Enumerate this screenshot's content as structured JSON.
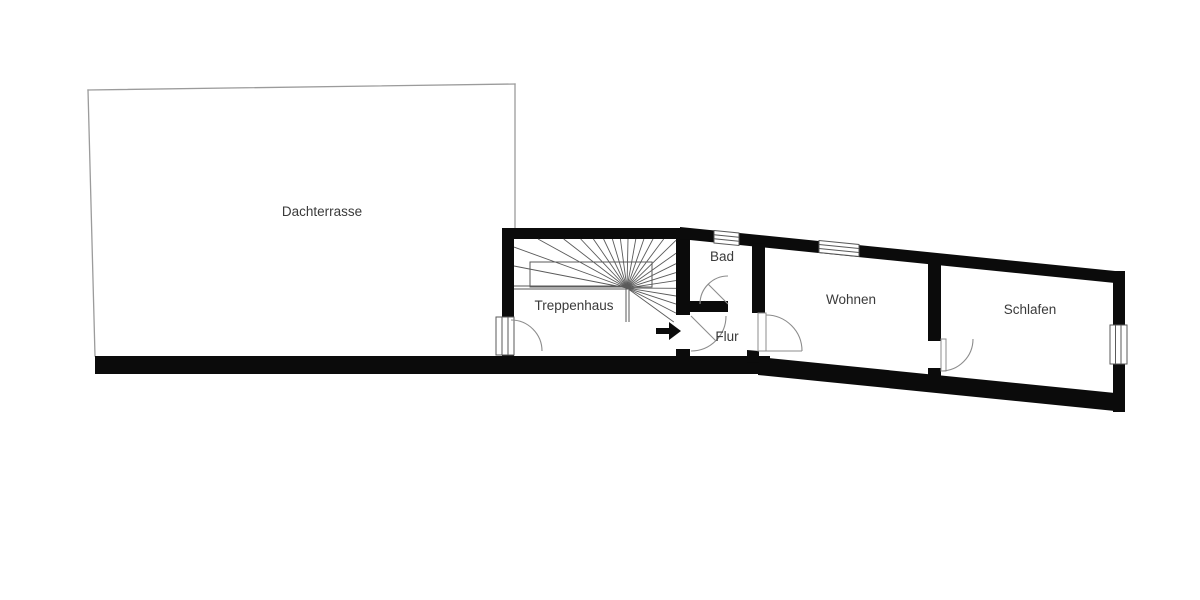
{
  "floorplan": {
    "rooms": {
      "dachterrasse": {
        "label": "Dachterrasse"
      },
      "treppenhaus": {
        "label": "Treppenhaus"
      },
      "bad": {
        "label": "Bad"
      },
      "flur": {
        "label": "Flur"
      },
      "wohnen": {
        "label": "Wohnen"
      },
      "schlafen": {
        "label": "Schlafen"
      }
    },
    "entrance_arrow": {
      "icon": "right-arrow",
      "direction": "right"
    },
    "colors": {
      "wall": "#0b0b0b",
      "thin_line": "#5a5a5a",
      "terrace_outline": "#9b9b9b",
      "door_arc": "#8c8c8c",
      "label_text": "#3a3a3a",
      "background": "#ffffff",
      "entrance_arrow": "#0b0b0b"
    }
  }
}
